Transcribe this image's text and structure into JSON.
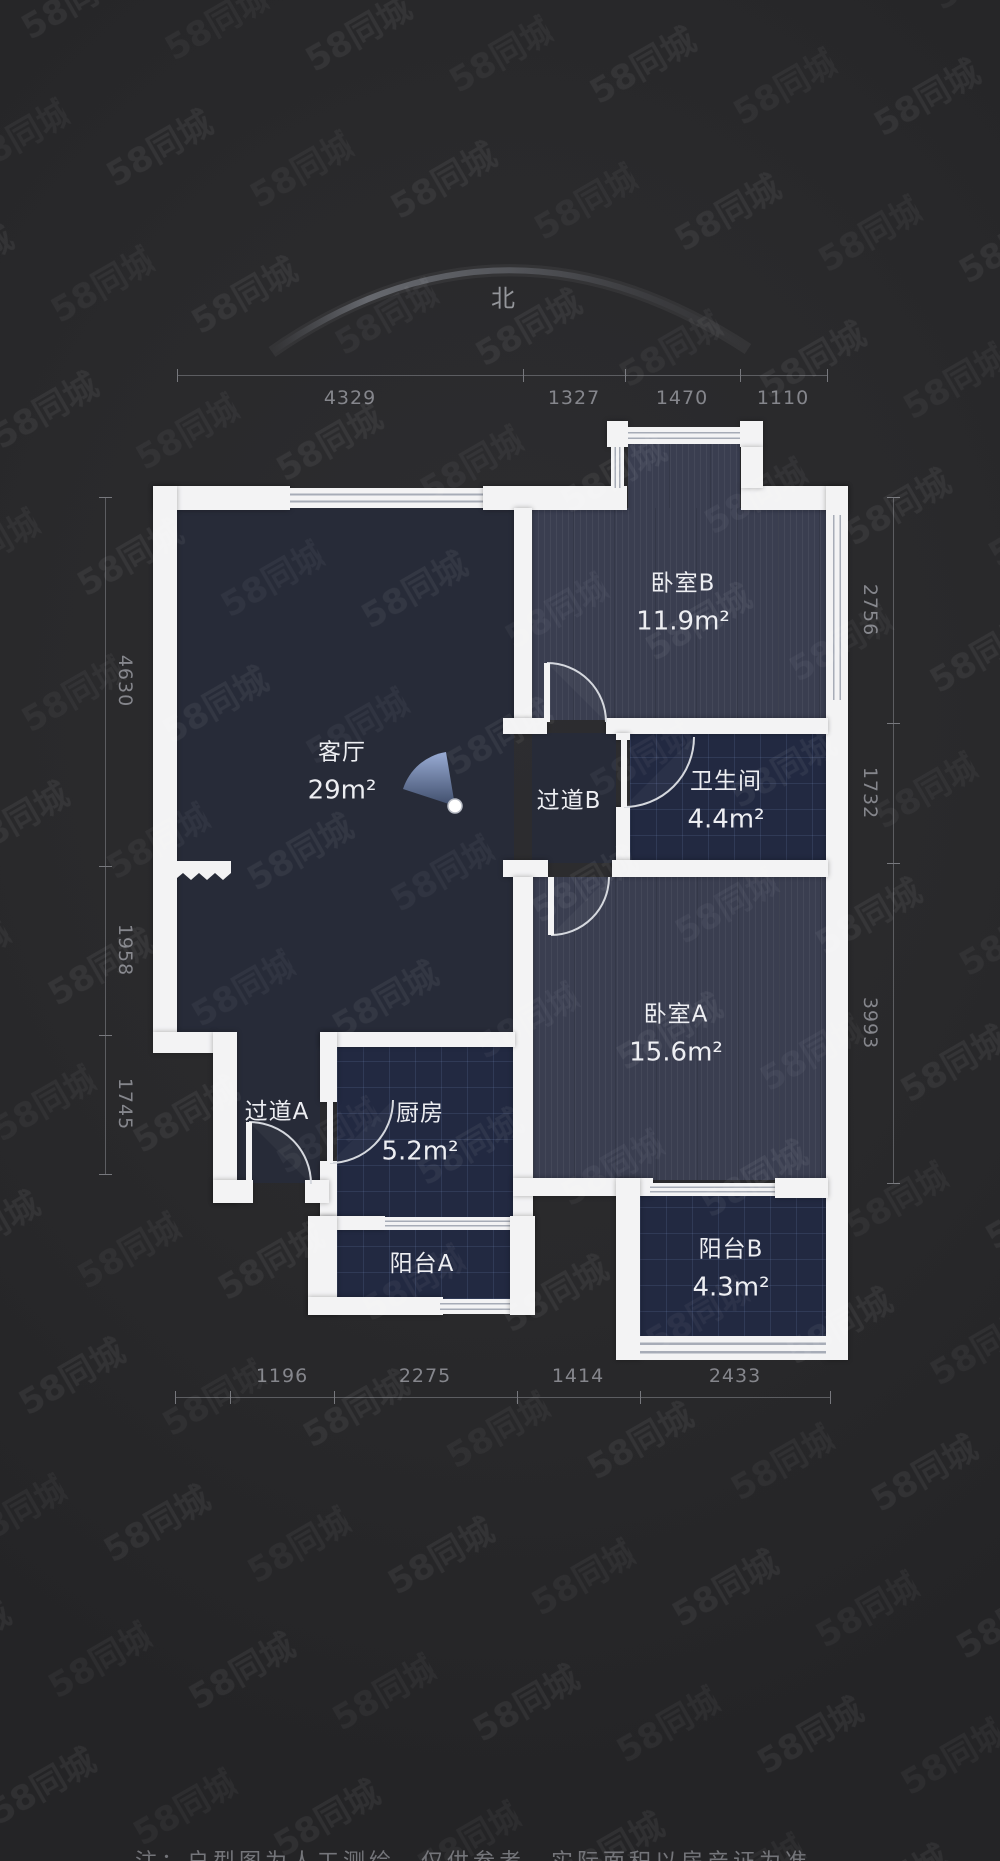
{
  "compass": {
    "north_label": "北"
  },
  "watermark": {
    "text": "58同城"
  },
  "rooms": {
    "living": {
      "name": "客厅",
      "area": "29m²"
    },
    "bedroom_b": {
      "name": "卧室B",
      "area": "11.9m²"
    },
    "hallway_b": {
      "name": "过道B"
    },
    "bathroom": {
      "name": "卫生间",
      "area": "4.4m²"
    },
    "bedroom_a": {
      "name": "卧室A",
      "area": "15.6m²"
    },
    "hallway_a": {
      "name": "过道A"
    },
    "kitchen": {
      "name": "厨房",
      "area": "5.2m²"
    },
    "balcony_a": {
      "name": "阳台A"
    },
    "balcony_b": {
      "name": "阳台B",
      "area": "4.3m²"
    }
  },
  "dimensions_mm": {
    "top": [
      "4329",
      "1327",
      "1470",
      "1110"
    ],
    "bottom": [
      "1196",
      "2275",
      "1414",
      "2433"
    ],
    "left": [
      "4630",
      "1958",
      "1745"
    ],
    "right": [
      "2756",
      "1732",
      "3993"
    ]
  },
  "disclaimer": "注：户型图为人工测绘，仅供参考，实际面积以房产证为准",
  "colors": {
    "background": "#29292b",
    "wall": "#f3f3f4",
    "floor_dark": "#272b38",
    "floor_wood": "#3a3e50",
    "floor_tile": "#222941",
    "dim_text": "#85868c",
    "room_text": "#edeef2",
    "fan_blue": "#8fa6d8"
  }
}
